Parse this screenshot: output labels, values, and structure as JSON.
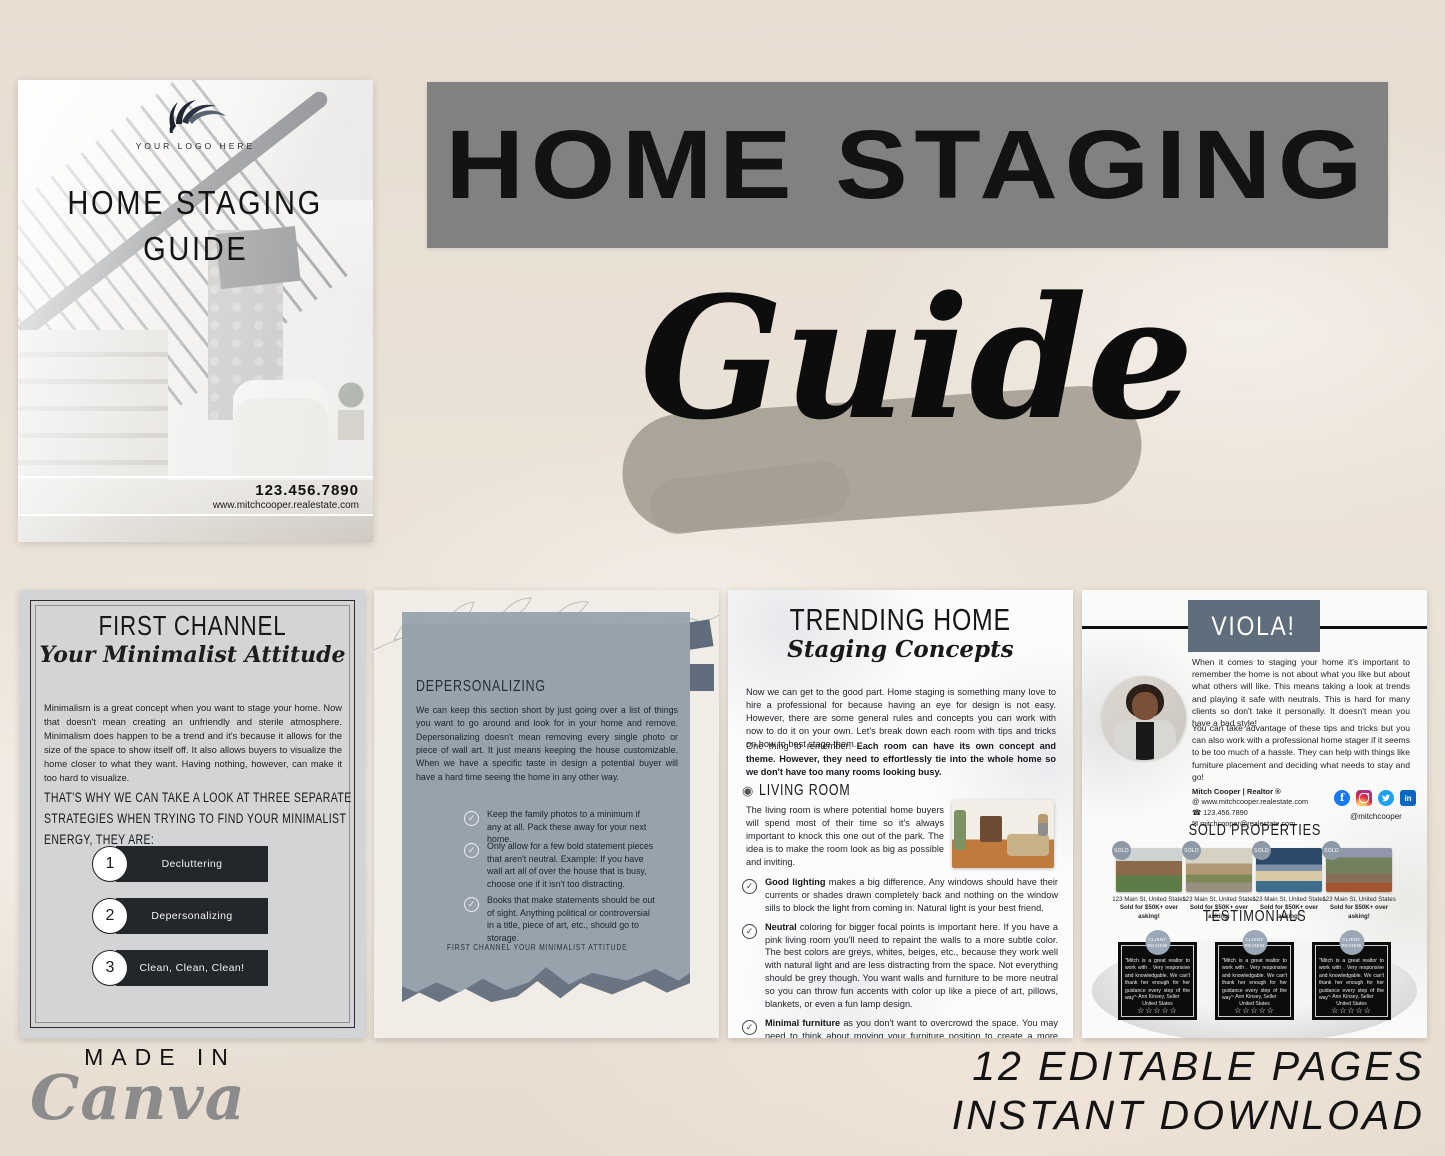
{
  "colors": {
    "background_cream": "#e8dfd3",
    "banner_gray": "#818181",
    "slate": "#5f6d7c",
    "panel_blue_gray": "#99a3ae",
    "dark_box": "#23262b",
    "canva_gray": "#8b8b8b",
    "black_text": "#141414"
  },
  "icons": {
    "check": "✓",
    "living_room": "◉",
    "phone": "☎",
    "email": "✉",
    "website": "@",
    "facebook": "f",
    "linkedin": "in"
  },
  "hero": {
    "banner_title": "HOME STAGING",
    "script_title": "Guide"
  },
  "cover": {
    "logo_text": "YOUR LOGO HERE",
    "title_line1": "HOME STAGING",
    "title_line2": "GUIDE",
    "phone": "123.456.7890",
    "website": "www.mitchcooper.realestate.com"
  },
  "pages": {
    "first_channel": {
      "title": "FIRST CHANNEL",
      "subtitle": "Your Minimalist Attitude",
      "body": "Minimalism is a great concept when you want to stage your home. Now that doesn't mean creating an unfriendly and sterile atmosphere. Minimalism does happen to be a trend and it's because it allows for the size of the space to show itself off. It also allows buyers to visualize the home closer to what they want. Having nothing, however, can make it too hard to visualize.",
      "strategies_intro": "THAT'S WHY WE CAN TAKE A LOOK AT THREE SEPARATE STRATEGIES WHEN TRYING TO FIND YOUR MINIMALIST ENERGY, THEY ARE:",
      "steps": [
        {
          "number": "1",
          "label": "Decluttering"
        },
        {
          "number": "2",
          "label": "Depersonalizing"
        },
        {
          "number": "3",
          "label": "Clean, Clean, Clean!"
        }
      ]
    },
    "depersonalizing": {
      "title": "DEPERSONALIZING",
      "body": "We can keep this section short by just going over a list of things you want to go around and look for in your home and remove. Depersonalizing doesn't mean removing every single photo or piece of wall art. It just means keeping the house customizable. When we have a specific taste in design a potential buyer will have a hard time seeing the home in any other way.",
      "checklist": [
        "Keep the family photos to a minimum if any at all. Pack these away for your next home.",
        "Only allow for a few bold statement pieces that aren't neutral. Example: If you have wall art all of over the house that is busy, choose one if it isn't too distracting.",
        "Books that make statements should be out of sight. Anything political or controversial in a title, piece of art, etc., should go to storage."
      ],
      "footer": "FIRST CHANNEL YOUR MINIMALIST ATTITUDE"
    },
    "trending": {
      "title": "TRENDING HOME",
      "subtitle": "Staging Concepts",
      "intro": "Now we can get to the good part. Home staging is something many love to hire a professional for because having an eye for design is not easy. However, there are some general rules and concepts you can work with now to do it on your own. Let's break down each room with tips and tricks on how to best stage them.",
      "reminder_prefix": "One thing to remember: ",
      "reminder_bold": "Each room can have its own concept and theme. However, they need to effortlessly tie into the whole home so we don't have too many rooms looking busy.",
      "living_room": {
        "heading": "LIVING ROOM",
        "body": "The living room is where potential home buyers will spend most of their time so it's always important to knock this one out of the park. The idea is to make the room look as big as possible and inviting.",
        "bullets": [
          {
            "bold": "Good lighting",
            "text": " makes a big difference. Any windows should have their currents or shades drawn completely back and nothing on the window sills to block the light from coming in. Natural light is your best friend."
          },
          {
            "bold": "Neutral",
            "text": " coloring for bigger focal points is important here. If you have a pink living room you'll need to repaint the walls to a more subtle color. The best colors are greys, whites, beiges, etc., because they work well with natural light and are less distracting from the space. Not everything should be grey though. You want walls and furniture to be more neutral so you can throw fun accents with color up like a piece of art, pillows, blankets, or even a fun lamp design."
          },
          {
            "bold": "Minimal furniture",
            "text": " as you don't want to overcrowd the space. You may need to think about moving your furniture position to create a more open floor plan. If there is a centerpiece like a fireplace or TV this can make it easier to find the right positioning."
          }
        ]
      }
    },
    "viola": {
      "title": "VIOLA!",
      "para1": "When it comes to staging your home it's important to remember the home is not about what you like but about what others will like. This means taking a look at trends and playing it safe with neutrals. This is hard for many clients so don't take it personally. It doesn't mean you have a bad style!",
      "para2": "You can take advantage of these tips and tricks but you can also work with a professional home stager if it seems to be too much of a hassle. They can help with things like furniture placement and deciding what needs to stay and go!",
      "contact": {
        "name": "Mitch Cooper | Realtor ®",
        "website": "www.mitchcooper.realestate.com",
        "phone": "123.456.7890",
        "email": "mitchcooper@realestate.com",
        "handle": "@mitchcooper"
      },
      "sold": {
        "heading": "SOLD PROPERTIES",
        "badge": "SOLD",
        "items": [
          {
            "line1": "123 Main St, United States",
            "line2": "Sold for $50K+ over asking!"
          },
          {
            "line1": "123 Main St, United States",
            "line2": "Sold for $50K+ over asking!"
          },
          {
            "line1": "123 Main St, United States",
            "line2": "Sold for $50K+ over asking!"
          },
          {
            "line1": "123 Main St, United States",
            "line2": "Sold for $50K+ over asking!"
          }
        ]
      },
      "testimonials": {
        "heading": "TESTIMONIALS",
        "badge": "CLIENT REVIEW",
        "cards": [
          {
            "quote": "\"Mitch is a great realtor to work with . Very responsive and knowledgable. We can't thank her enough for her guidance every step of the way\"",
            "author": "- Ann Kinsey, Seller",
            "location": "United States",
            "stars": "☆☆☆☆☆"
          },
          {
            "quote": "\"Mitch is a great realtor to work with . Very responsive and knowledgable. We can't thank her enough for her guidance every step of the way\"",
            "author": "- Ann Kinsey, Seller",
            "location": "United States",
            "stars": "☆☆☆☆☆"
          },
          {
            "quote": "\"Mitch is a great realtor to work with . Very responsive and knowledgable. We can't thank her enough for her guidance every step of the way\"",
            "author": "- Ann Kinsey, Seller",
            "location": "United States",
            "stars": "☆☆☆☆☆"
          }
        ]
      }
    }
  },
  "footer": {
    "made_in": "MADE IN",
    "canva": "Canva",
    "line1": "12 EDITABLE PAGES",
    "line2": "INSTANT DOWNLOAD"
  }
}
